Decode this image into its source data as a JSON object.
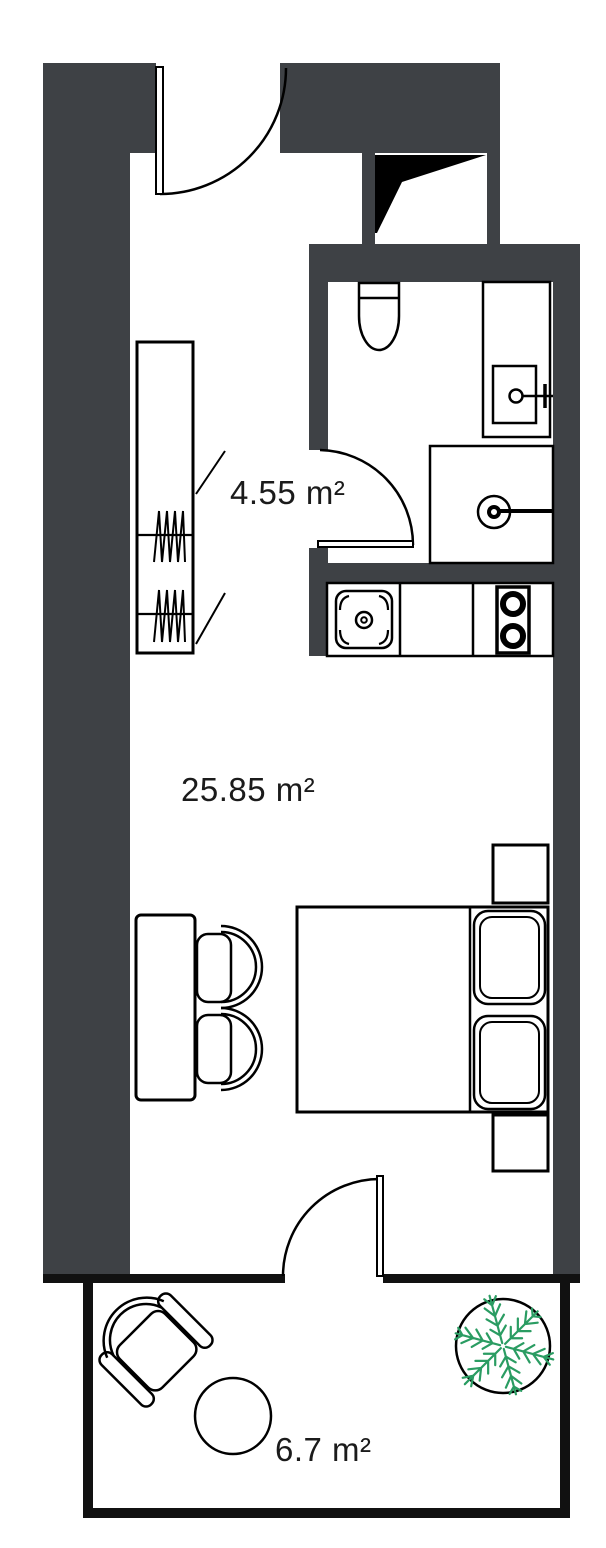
{
  "plan": {
    "rooms": [
      {
        "name": "bathroom",
        "area_label": "4.55 m²"
      },
      {
        "name": "main-room",
        "area_label": "25.85 m²"
      },
      {
        "name": "balcony",
        "area_label": "6.7 m²"
      }
    ],
    "colors": {
      "wall_fill": "#3e4145",
      "line": "#000000",
      "thin_wall": "#111111",
      "plant_green": "#2a9c62",
      "background": "#ffffff",
      "label_text": "#1b1b1b"
    },
    "fixtures": {
      "bathroom": [
        "toilet",
        "washbasin",
        "shower"
      ],
      "kitchen": [
        "kitchen-sink",
        "counter",
        "cooktop-two-burners"
      ],
      "main_room": [
        "wardrobe",
        "desk",
        "two-desk-chairs",
        "double-bed",
        "two-pillows",
        "two-nightstands"
      ],
      "balcony": [
        "armchair",
        "round-table",
        "potted-plant"
      ],
      "doors": [
        "entry-door",
        "bathroom-door",
        "balcony-door"
      ],
      "shaft": "ventilation-shaft"
    }
  }
}
